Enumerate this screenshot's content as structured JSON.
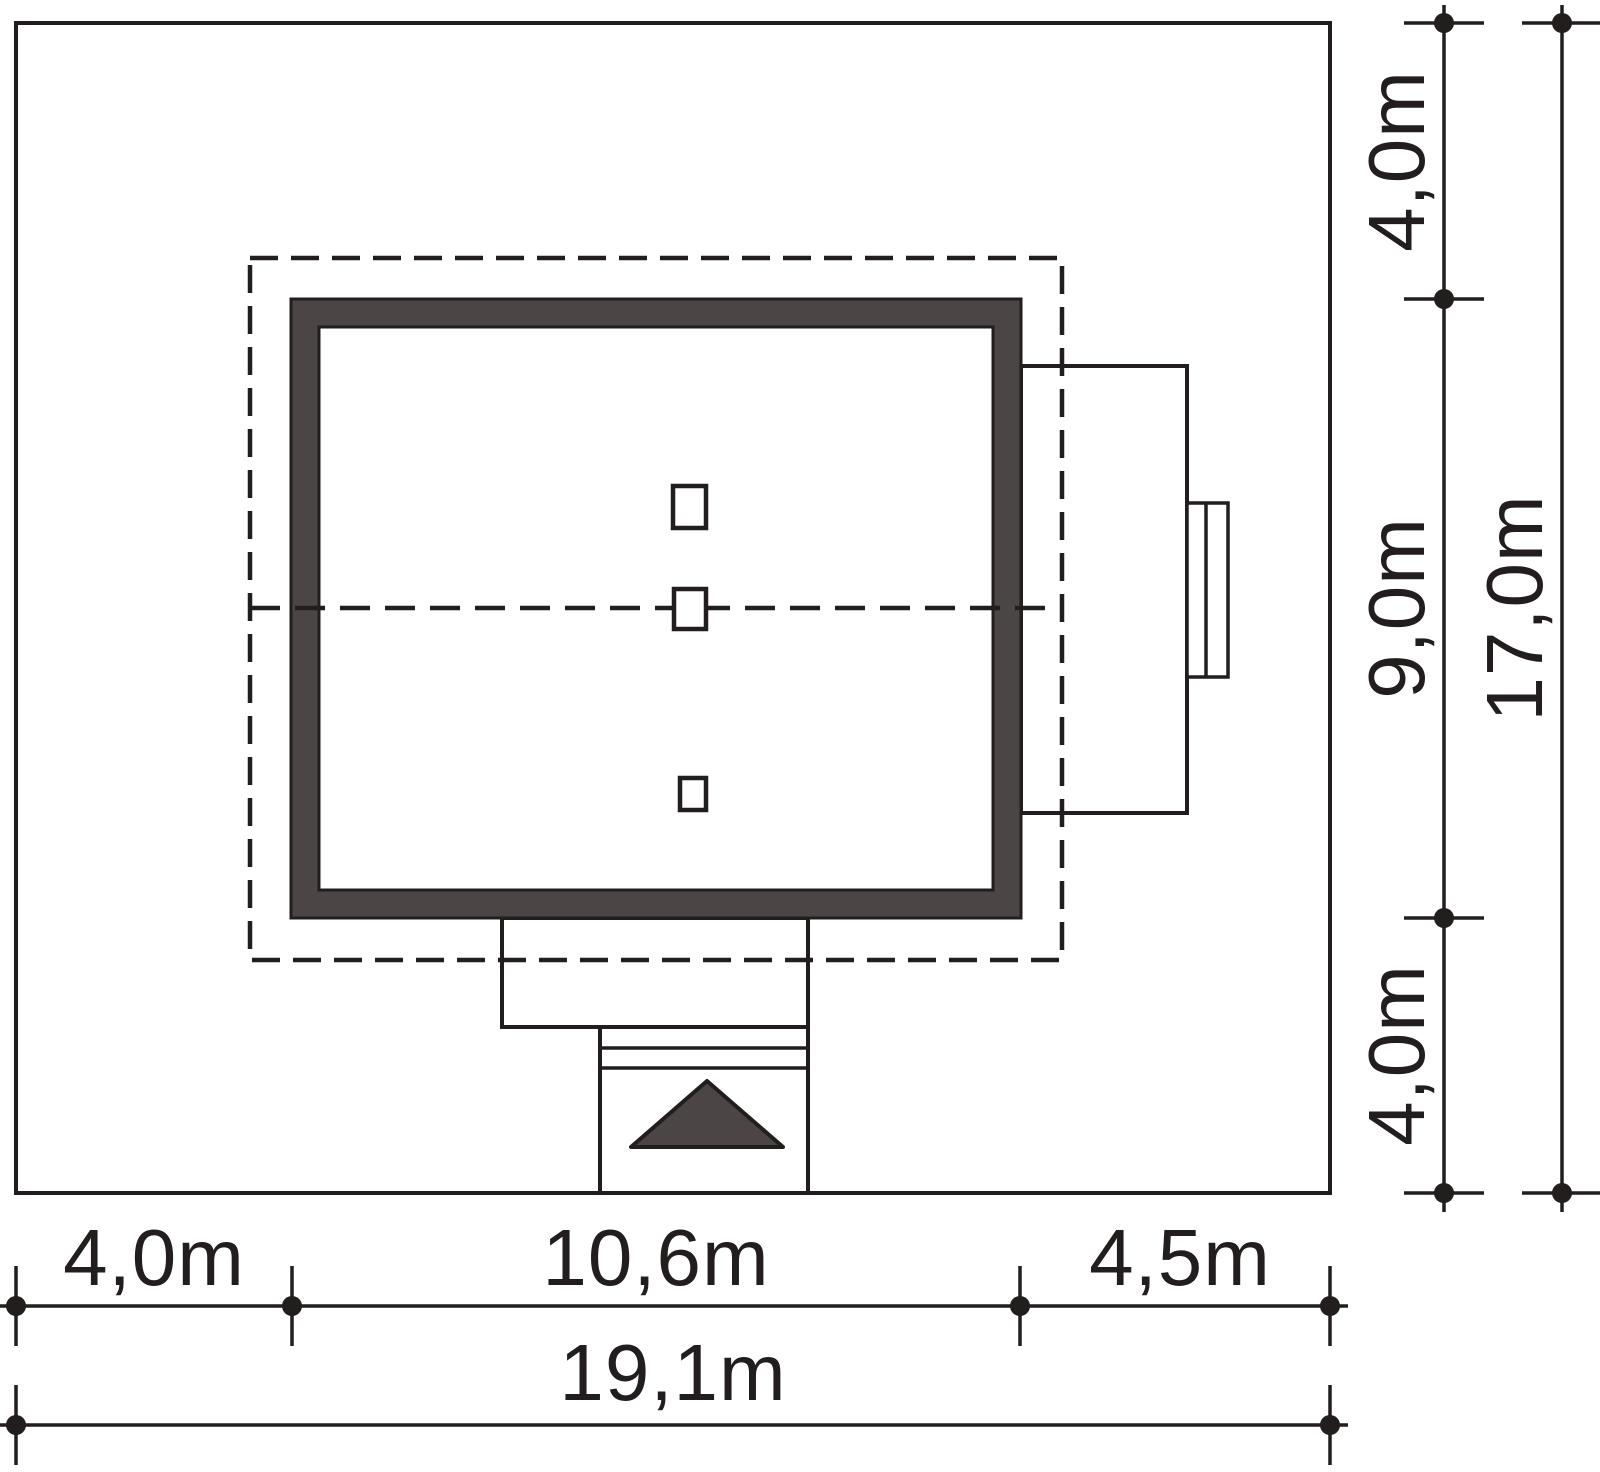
{
  "drawing": {
    "type": "house-site-plan",
    "colors": {
      "line": "#211e1d",
      "dark_fill": "#4b4645",
      "background": "#ffffff"
    },
    "dimensions": {
      "bottom_primary": {
        "segments": [
          {
            "label": "4,0m"
          },
          {
            "label": "10,6m"
          },
          {
            "label": "4,5m"
          }
        ]
      },
      "bottom_total": {
        "label": "19,1m"
      },
      "right_primary": {
        "segments": [
          {
            "label": "4,0m"
          },
          {
            "label": "9,0m"
          },
          {
            "label": "4,0m"
          }
        ]
      },
      "right_total": {
        "label": "17,0m"
      }
    }
  }
}
